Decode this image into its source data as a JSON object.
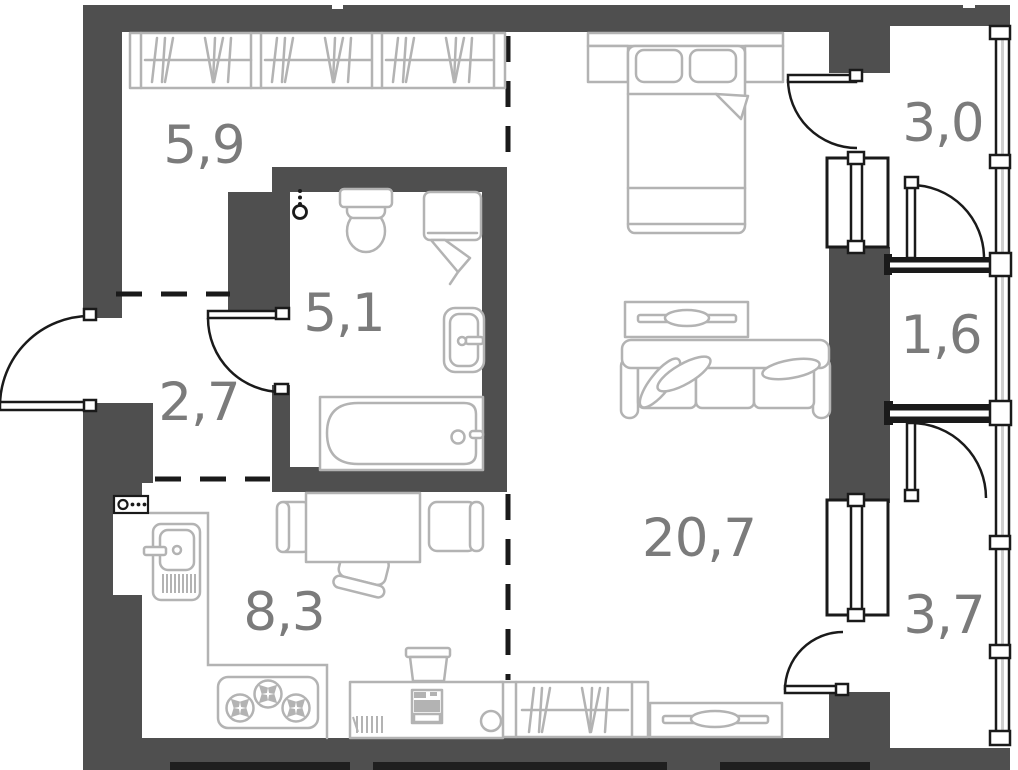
{
  "plan": {
    "type": "studio apartment floor plan",
    "rooms": [
      {
        "name": "wardrobe-hall",
        "area_label": "5,9"
      },
      {
        "name": "bathroom",
        "area_label": "5,1"
      },
      {
        "name": "entry-hall",
        "area_label": "2,7"
      },
      {
        "name": "kitchen",
        "area_label": "8,3"
      },
      {
        "name": "living-room",
        "area_label": "20,7"
      },
      {
        "name": "balcony-upper",
        "area_label": "3,0"
      },
      {
        "name": "balcony-middle",
        "area_label": "1,6"
      },
      {
        "name": "balcony-lower",
        "area_label": "3,7"
      }
    ],
    "colors": {
      "wall": "#4f4f4f",
      "furniture": "#b3b3b3",
      "line": "#1a1a1a",
      "label": "#7b7b7b",
      "background": "#ffffff"
    }
  }
}
